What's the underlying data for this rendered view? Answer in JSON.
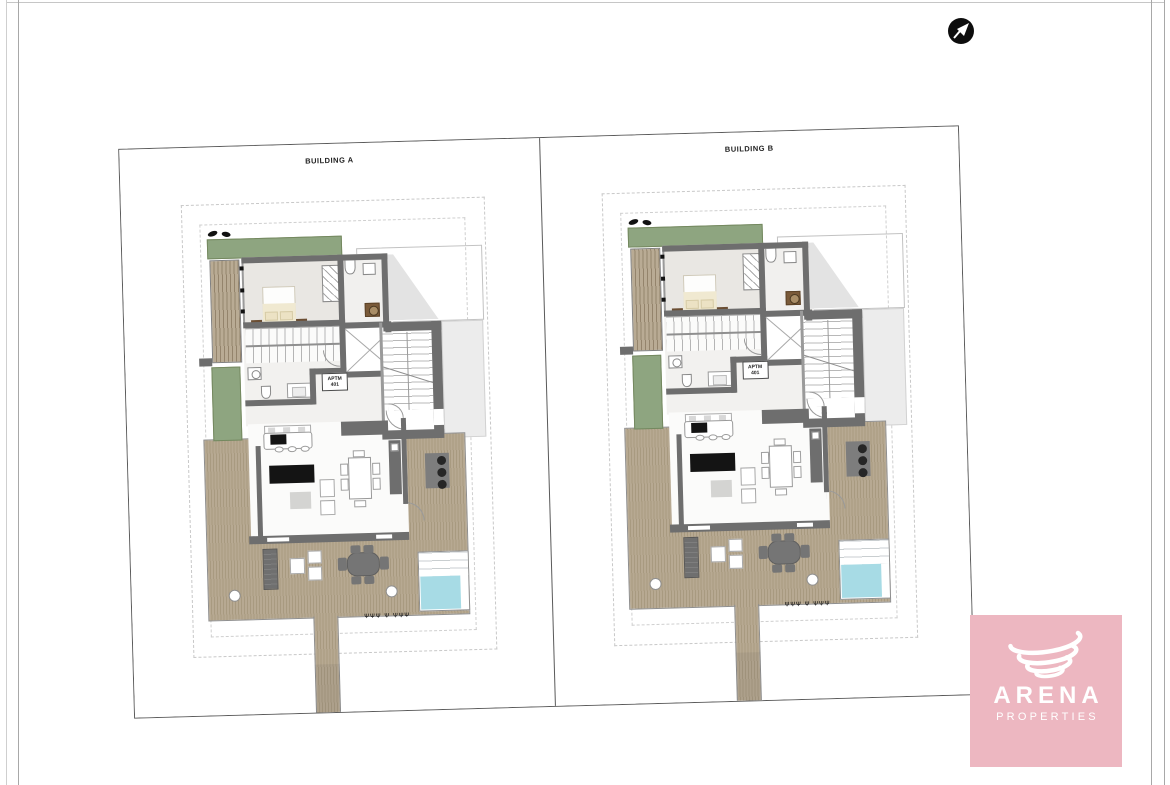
{
  "buildings": [
    {
      "label": "BUILDING A",
      "apartment": {
        "line1": "APTM",
        "line2": "401"
      }
    },
    {
      "label": "BUILDING B",
      "apartment": {
        "line1": "APTM",
        "line2": "401"
      }
    }
  ],
  "plan": {
    "shrub_glyphs": "ΨΨΨ  Ψ  ΨΨΨ"
  },
  "brand": {
    "name": "ARENA",
    "tagline": "PROPERTIES"
  },
  "colors": {
    "brand_bg": "#edb7c1",
    "brand_text": "#ffffff",
    "wall": "#6e6e6e",
    "deck": "#b2a48c",
    "planter": "#8ea580",
    "pool": "#a7dbe5",
    "shadow": "#e3e3e3",
    "sheet_border": "#5a5a5a"
  }
}
